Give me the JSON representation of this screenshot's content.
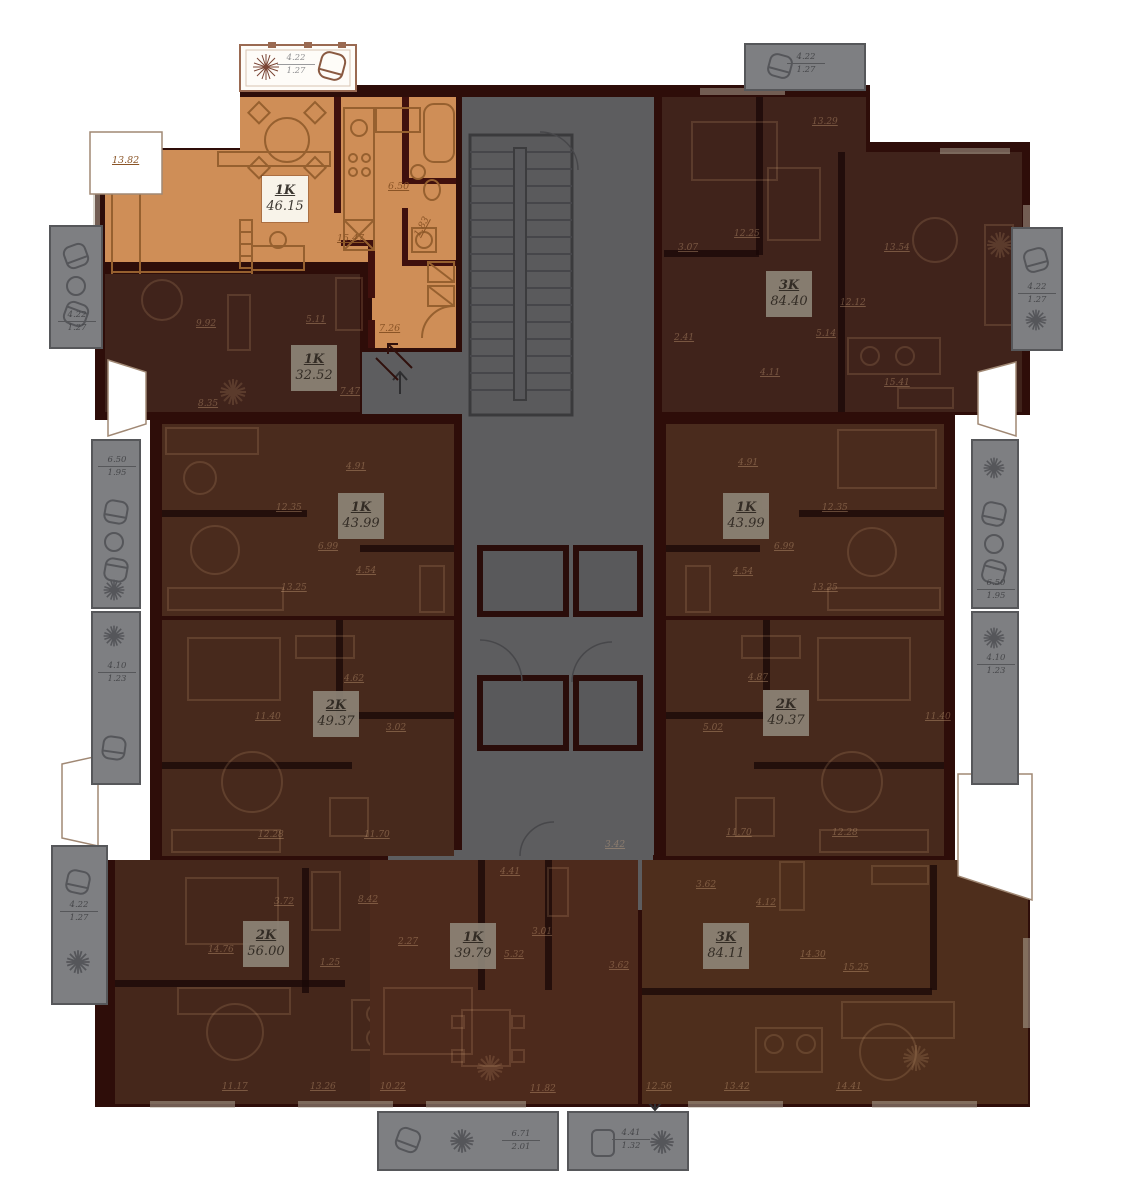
{
  "colors": {
    "active_fill": "#cf8e57",
    "dim_fill": "#42251c",
    "wall": "#2e0d09",
    "core": "#5d5d5f",
    "balcony": "#7e7f82",
    "label_box_active": "#f8f3e9",
    "label_box_dim": "#8d8477"
  },
  "apartments": [
    {
      "type": "1K",
      "area": "46.15",
      "state": "active"
    },
    {
      "type": "1K",
      "area": "32.52",
      "state": "dim"
    },
    {
      "type": "3K",
      "area": "84.40",
      "state": "dim"
    },
    {
      "type": "1K",
      "area": "43.99",
      "state": "dim"
    },
    {
      "type": "1K",
      "area": "43.99",
      "state": "dim"
    },
    {
      "type": "2K",
      "area": "49.37",
      "state": "dim"
    },
    {
      "type": "2K",
      "area": "49.37",
      "state": "dim"
    },
    {
      "type": "2K",
      "area": "56.00",
      "state": "dim"
    },
    {
      "type": "1K",
      "area": "39.79",
      "state": "dim"
    },
    {
      "type": "3K",
      "area": "84.11",
      "state": "dim"
    }
  ],
  "room_dims": {
    "a46": [
      "13.82",
      "6.50",
      "15.47",
      "1.83",
      "7.26"
    ],
    "a32": [
      "9.92",
      "5.11",
      "7.47",
      "8.35"
    ],
    "a84a": [
      "13.29",
      "12.25",
      "3.07",
      "13.54",
      "12.12",
      "2.41",
      "5.14",
      "4.11",
      "15.41"
    ],
    "a43l": [
      "4.91",
      "12.35",
      "6.99",
      "4.54",
      "13.25"
    ],
    "a43r": [
      "4.91",
      "12.35",
      "6.99",
      "4.54",
      "13.25"
    ],
    "a49l": [
      "4.62",
      "11.40",
      "3.02",
      "12.28",
      "11.70"
    ],
    "a49r": [
      "4.87",
      "11.40",
      "5.02",
      "11.70",
      "12.28"
    ],
    "a56": [
      "3.72",
      "8.42",
      "14.76",
      "1.25",
      "11.17",
      "13.26"
    ],
    "a39": [
      "4.41",
      "3.42",
      "2.27",
      "3.01",
      "5.32",
      "3.62",
      "10.22",
      "11.82"
    ],
    "a84b": [
      "3.62",
      "4.12",
      "14.30",
      "15.25",
      "12.56",
      "13.42",
      "14.41"
    ]
  },
  "balconies": [
    {
      "area": "4.22",
      "k": "1.27"
    },
    {
      "area": "4.22",
      "k": "1.27"
    },
    {
      "area": "4.22",
      "k": "1.27"
    },
    {
      "area": "6.50",
      "k": "1.95"
    },
    {
      "area": "4.10",
      "k": "1.23"
    },
    {
      "area": "4.22",
      "k": "1.27"
    },
    {
      "area": "4.22",
      "k": "1.27"
    },
    {
      "area": "6.50",
      "k": "1.95"
    },
    {
      "area": "4.10",
      "k": "1.23"
    },
    {
      "area": "6.71",
      "k": "2.01"
    },
    {
      "area": "4.41",
      "k": "1.32"
    }
  ]
}
